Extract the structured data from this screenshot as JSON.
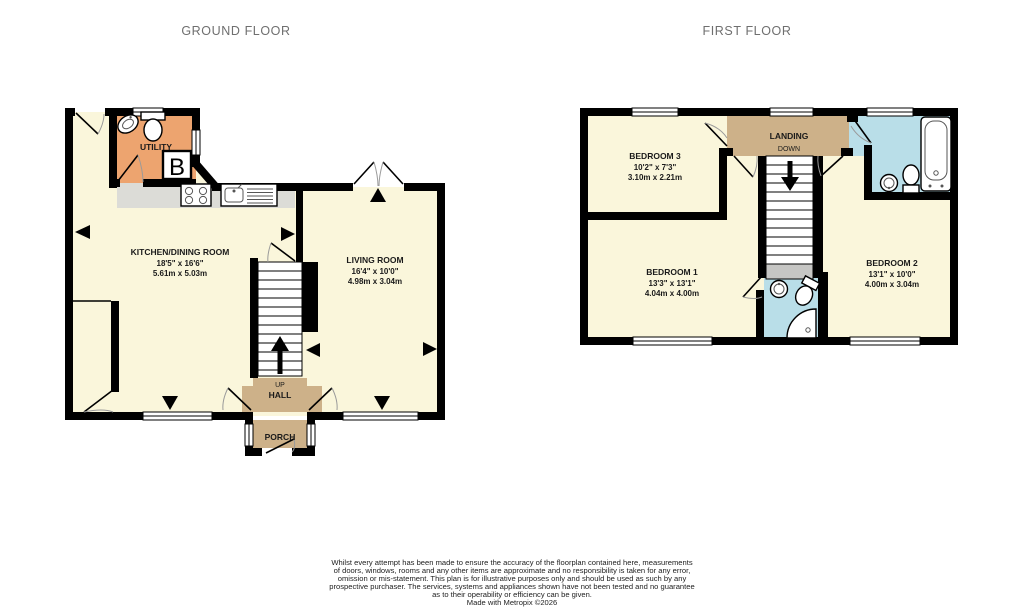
{
  "titles": {
    "ground": "GROUND FLOOR",
    "first": "FIRST FLOOR"
  },
  "ground_floor": {
    "utility": {
      "name": "UTILITY"
    },
    "boiler": {
      "label": "B"
    },
    "kitchen": {
      "name": "KITCHEN/DINING ROOM",
      "imperial": "18'5\" x 16'6\"",
      "metric": "5.61m x 5.03m"
    },
    "living": {
      "name": "LIVING ROOM",
      "imperial": "16'4\" x 10'0\"",
      "metric": "4.98m x 3.04m"
    },
    "hall": {
      "up": "UP",
      "name": "HALL"
    },
    "porch": {
      "name": "PORCH"
    }
  },
  "first_floor": {
    "bedroom3": {
      "name": "BEDROOM 3",
      "imperial": "10'2\" x 7'3\"",
      "metric": "3.10m x 2.21m"
    },
    "landing": {
      "name": "LANDING",
      "down": "DOWN"
    },
    "bedroom1": {
      "name": "BEDROOM 1",
      "imperial": "13'3\" x 13'1\"",
      "metric": "4.04m x 4.00m"
    },
    "bedroom2": {
      "name": "BEDROOM 2",
      "imperial": "13'1\" x 10'0\"",
      "metric": "4.00m x 3.04m"
    }
  },
  "disclaimer": {
    "lines": [
      "Whilst every attempt has been made to ensure the accuracy of the floorplan contained here, measurements",
      "of doors, windows, rooms and any other items are approximate and no responsibility is taken for any error,",
      "omission or mis-statement. This plan is for illustrative purposes only and should be used as such by any",
      "prospective purchaser. The services, systems and appliances shown have not been tested and no guarantee",
      "as to their operability or efficiency can be given.",
      "Made with Metropix ©2026"
    ]
  },
  "colors": {
    "room_cream": "#FAF6DB",
    "hall_tan": "#CDB189",
    "utility_orange": "#EDA46F",
    "bathroom_blue": "#B9DEE8",
    "counter_gray": "#DCDCD7",
    "stair_gray": "#C6C6C4",
    "wall_black": "#000000",
    "title_gray": "#6F6F6F"
  }
}
